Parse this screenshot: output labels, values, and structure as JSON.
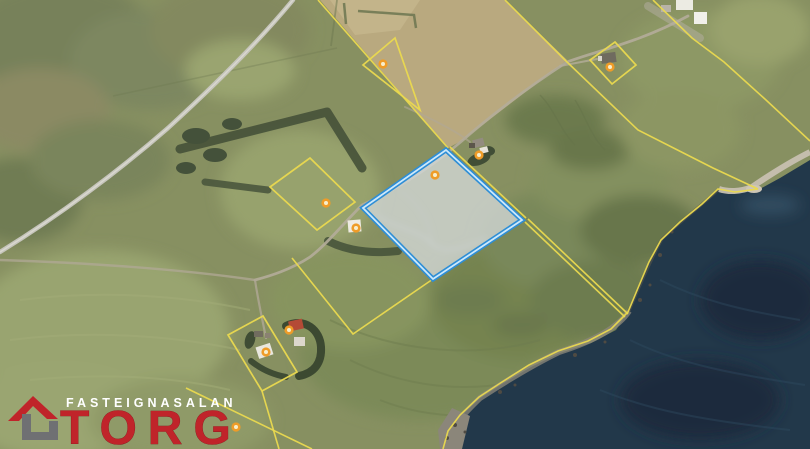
{
  "brand": {
    "tagline": "FASTEIGNASALAN",
    "name": "TORG",
    "accent_red": "#c0242a",
    "icon": "house-logo"
  },
  "map": {
    "imagery": "aerial-satellite",
    "boundary_color": "#ead94f",
    "highlight_stroke": "#2e8ed6",
    "highlight_inner_stroke": "#cde9fb",
    "marker_color": "#ef9c28",
    "marker_center_color": "#f8eecb",
    "highlighted_parcel": {
      "name": "highlighted-parcel",
      "points": [
        [
          446,
          150
        ],
        [
          522,
          220
        ],
        [
          433,
          279
        ],
        [
          363,
          208
        ]
      ],
      "fill": "#d4d8d9",
      "fill_opacity": 0.78
    },
    "parcels": [
      {
        "name": "parcel-left",
        "points": [
          [
            310,
            158
          ],
          [
            355,
            202
          ],
          [
            317,
            230
          ],
          [
            270,
            187
          ]
        ]
      },
      {
        "name": "parcel-diamond-ne",
        "points": [
          [
            615,
            42
          ],
          [
            636,
            65
          ],
          [
            612,
            84
          ],
          [
            590,
            60
          ]
        ]
      },
      {
        "name": "parcel-farm-sw",
        "points": [
          [
            263,
            316
          ],
          [
            297,
            372
          ],
          [
            262,
            391
          ],
          [
            228,
            335
          ]
        ]
      },
      {
        "name": "parcel-triangle-n",
        "points": [
          [
            395,
            38
          ],
          [
            363,
            65
          ],
          [
            420,
            110
          ]
        ]
      }
    ],
    "boundary_lines": [
      {
        "name": "boundary-north",
        "points": [
          [
            318,
            0
          ],
          [
            448,
            148
          ]
        ]
      },
      {
        "name": "boundary-parcel-ne-edge",
        "points": [
          [
            450,
            147
          ],
          [
            526,
            218
          ]
        ]
      },
      {
        "name": "boundary-shared-a",
        "points": [
          [
            525,
            222
          ],
          [
            625,
            317
          ]
        ]
      },
      {
        "name": "boundary-shared-b",
        "points": [
          [
            528,
            219
          ],
          [
            628,
            314
          ]
        ]
      },
      {
        "name": "boundary-road-cross",
        "points": [
          [
            505,
            0
          ],
          [
            567,
            62
          ],
          [
            638,
            130
          ],
          [
            713,
            168
          ],
          [
            758,
            189
          ]
        ]
      },
      {
        "name": "boundary-coastline",
        "points": [
          [
            758,
            189
          ],
          [
            735,
            192
          ],
          [
            718,
            189
          ],
          [
            702,
            204
          ],
          [
            680,
            222
          ],
          [
            661,
            240
          ],
          [
            649,
            262
          ],
          [
            638,
            288
          ],
          [
            628,
            312
          ],
          [
            623,
            317
          ],
          [
            611,
            329
          ],
          [
            588,
            341
          ],
          [
            558,
            351
          ],
          [
            529,
            365
          ],
          [
            502,
            382
          ],
          [
            479,
            397
          ],
          [
            460,
            415
          ],
          [
            448,
            431
          ],
          [
            443,
            449
          ]
        ]
      },
      {
        "name": "boundary-northeast",
        "points": [
          [
            653,
            0
          ],
          [
            692,
            38
          ],
          [
            724,
            62
          ],
          [
            766,
            100
          ],
          [
            810,
            141
          ]
        ]
      },
      {
        "name": "boundary-v-south",
        "points": [
          [
            292,
            258
          ],
          [
            353,
            334
          ],
          [
            433,
            279
          ]
        ]
      },
      {
        "name": "boundary-farm-extension",
        "points": [
          [
            262,
            391
          ],
          [
            279,
            449
          ]
        ]
      },
      {
        "name": "boundary-southwest",
        "points": [
          [
            186,
            388
          ],
          [
            312,
            449
          ]
        ]
      }
    ],
    "markers": [
      {
        "name": "marker-highlighted-parcel",
        "x": 435,
        "y": 175
      },
      {
        "name": "marker-farm-ne",
        "x": 479,
        "y": 155
      },
      {
        "name": "marker-diamond-parcel",
        "x": 610,
        "y": 67
      },
      {
        "name": "marker-parcel-left",
        "x": 326,
        "y": 203
      },
      {
        "name": "marker-triangle-parcel",
        "x": 383,
        "y": 64
      },
      {
        "name": "marker-building-mid",
        "x": 356,
        "y": 228
      },
      {
        "name": "marker-farm-sw-house",
        "x": 266,
        "y": 352
      },
      {
        "name": "marker-farm-sw-red",
        "x": 289,
        "y": 330
      },
      {
        "name": "marker-near-logo",
        "x": 236,
        "y": 427
      }
    ]
  }
}
